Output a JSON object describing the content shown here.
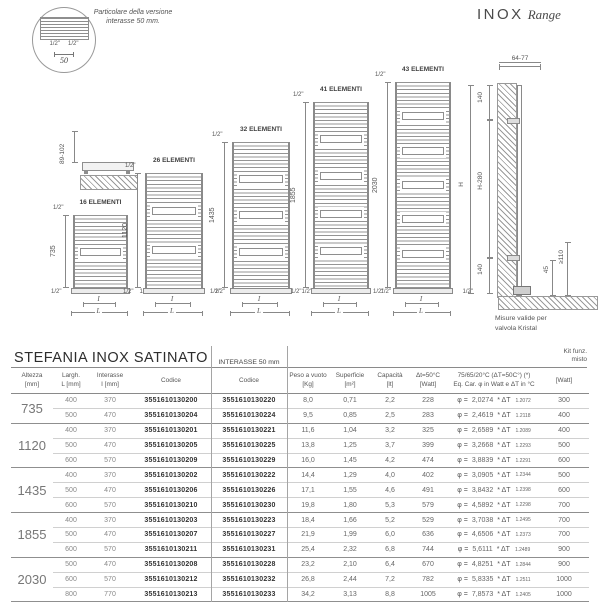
{
  "brand": {
    "name": "INOX",
    "range": "Range"
  },
  "detail": {
    "note": "Particolare della versione\ninterasse 50 mm.",
    "fitting_left": "1/2\"",
    "fitting_right": "1/2\"",
    "dim": "50"
  },
  "wallmount": {
    "dim": "89-102"
  },
  "drawings": {
    "fitting": "1/2\"",
    "dim_inner": "I",
    "dim_outer": "L",
    "radiators": [
      {
        "elements": "16 ELEMENTI",
        "height": "735",
        "windows": 1
      },
      {
        "elements": "26 ELEMENTI",
        "height": "1120",
        "windows": 2
      },
      {
        "elements": "32 ELEMENTI",
        "height": "1435",
        "windows": 3
      },
      {
        "elements": "41 ELEMENTI",
        "height": "1855",
        "windows": 4
      },
      {
        "elements": "43 ELEMENTI",
        "height": "2030",
        "windows": 5
      }
    ],
    "sideview": {
      "top_dim": "64-77",
      "dim_top": "140",
      "dim_h": "H",
      "dim_mid": "H-280",
      "dim_bottom": "140",
      "dim_45": "45",
      "dim_110": "≥110",
      "caption": "Misure valide per\nvalvola      Kristal"
    }
  },
  "table": {
    "title": "STEFANIA INOX SATINATO",
    "group2_title": "INTERASSE 50 mm",
    "kit_header": {
      "l1": "Kit funz.",
      "l2": "misto",
      "l3": "[Watt]"
    },
    "eq_format": {
      "phi": "φ =",
      "mult": "* ΔT"
    },
    "col_headers": {
      "altezza": {
        "l1": "Altezza",
        "l2": "[mm]"
      },
      "largh": {
        "l1": "Largh.",
        "l2": "L [mm]"
      },
      "interasse": {
        "l1": "Interasse",
        "l2": "I [mm]"
      },
      "codice": "Codice",
      "codice50": "Codice",
      "peso": {
        "l1": "Peso a vuoto",
        "l2": "[Kg]"
      },
      "superficie": {
        "l1": "Superficie",
        "l2": "[m²]"
      },
      "capacita": {
        "l1": "Capacità",
        "l2": "[lt]"
      },
      "dt": {
        "l1": "Δt=50°C",
        "l2": "[Watt]"
      },
      "eq": {
        "l1": "75/65/20°C (ΔT=50C°) (*)",
        "l2": "Eq. Car. φ in Watt e ΔT in °C"
      }
    },
    "groups": [
      {
        "altezza": "735",
        "rows": [
          {
            "largh": "400",
            "interasse": "370",
            "codice": "3551610130200",
            "codice50": "3551610130220",
            "peso": "8,0",
            "superficie": "0,71",
            "capacita": "2,2",
            "watt": "228",
            "eq_coeff": "2,0274",
            "eq_exp": "1.2072",
            "kit": "300"
          },
          {
            "largh": "500",
            "interasse": "470",
            "codice": "3551610130204",
            "codice50": "3551610130224",
            "peso": "9,5",
            "superficie": "0,85",
            "capacita": "2,5",
            "watt": "283",
            "eq_coeff": "2,4619",
            "eq_exp": "1.2118",
            "kit": "400"
          }
        ]
      },
      {
        "altezza": "1120",
        "rows": [
          {
            "largh": "400",
            "interasse": "370",
            "codice": "3551610130201",
            "codice50": "3551610130221",
            "peso": "11,6",
            "superficie": "1,04",
            "capacita": "3,2",
            "watt": "325",
            "eq_coeff": "2,6589",
            "eq_exp": "1.2089",
            "kit": "400"
          },
          {
            "largh": "500",
            "interasse": "470",
            "codice": "3551610130205",
            "codice50": "3551610130225",
            "peso": "13,8",
            "superficie": "1,25",
            "capacita": "3,7",
            "watt": "399",
            "eq_coeff": "3,2668",
            "eq_exp": "1.2293",
            "kit": "500"
          },
          {
            "largh": "600",
            "interasse": "570",
            "codice": "3551610130209",
            "codice50": "3551610130229",
            "peso": "16,0",
            "superficie": "1,45",
            "capacita": "4,2",
            "watt": "474",
            "eq_coeff": "3,8839",
            "eq_exp": "1.2291",
            "kit": "600"
          }
        ]
      },
      {
        "altezza": "1435",
        "rows": [
          {
            "largh": "400",
            "interasse": "370",
            "codice": "3551610130202",
            "codice50": "3551610130222",
            "peso": "14,4",
            "superficie": "1,29",
            "capacita": "4,0",
            "watt": "402",
            "eq_coeff": "3,0905",
            "eq_exp": "1.2344",
            "kit": "500"
          },
          {
            "largh": "500",
            "interasse": "470",
            "codice": "3551610130206",
            "codice50": "3551610130226",
            "peso": "17,1",
            "superficie": "1,55",
            "capacita": "4,6",
            "watt": "491",
            "eq_coeff": "3,8432",
            "eq_exp": "1.2398",
            "kit": "600"
          },
          {
            "largh": "600",
            "interasse": "570",
            "codice": "3551610130210",
            "codice50": "3551610130230",
            "peso": "19,8",
            "superficie": "1,80",
            "capacita": "5,3",
            "watt": "579",
            "eq_coeff": "4,5892",
            "eq_exp": "1.2298",
            "kit": "700"
          }
        ]
      },
      {
        "altezza": "1855",
        "rows": [
          {
            "largh": "400",
            "interasse": "370",
            "codice": "3551610130203",
            "codice50": "3551610130223",
            "peso": "18,4",
            "superficie": "1,66",
            "capacita": "5,2",
            "watt": "529",
            "eq_coeff": "3,7038",
            "eq_exp": "1.2495",
            "kit": "700"
          },
          {
            "largh": "500",
            "interasse": "470",
            "codice": "3551610130207",
            "codice50": "3551610130227",
            "peso": "21,9",
            "superficie": "1,99",
            "capacita": "6,0",
            "watt": "636",
            "eq_coeff": "4,6506",
            "eq_exp": "1.2373",
            "kit": "700"
          },
          {
            "largh": "600",
            "interasse": "570",
            "codice": "3551610130211",
            "codice50": "3551610130231",
            "peso": "25,4",
            "superficie": "2,32",
            "capacita": "6,8",
            "watt": "744",
            "eq_coeff": "5,6111",
            "eq_exp": "1.2489",
            "kit": "900"
          }
        ]
      },
      {
        "altezza": "2030",
        "rows": [
          {
            "largh": "500",
            "interasse": "470",
            "codice": "3551610130208",
            "codice50": "3551610130228",
            "peso": "23,2",
            "superficie": "2,10",
            "capacita": "6,4",
            "watt": "670",
            "eq_coeff": "4,8251",
            "eq_exp": "1.2844",
            "kit": "900"
          },
          {
            "largh": "600",
            "interasse": "570",
            "codice": "3551610130212",
            "codice50": "3551610130232",
            "peso": "26,8",
            "superficie": "2,44",
            "capacita": "7,2",
            "watt": "782",
            "eq_coeff": "5,8335",
            "eq_exp": "1.2511",
            "kit": "1000"
          },
          {
            "largh": "800",
            "interasse": "770",
            "codice": "3551610130213",
            "codice50": "3551610130233",
            "peso": "34,2",
            "superficie": "3,13",
            "capacita": "8,8",
            "watt": "1005",
            "eq_coeff": "7,8573",
            "eq_exp": "1.2405",
            "kit": "1000"
          }
        ]
      }
    ]
  }
}
